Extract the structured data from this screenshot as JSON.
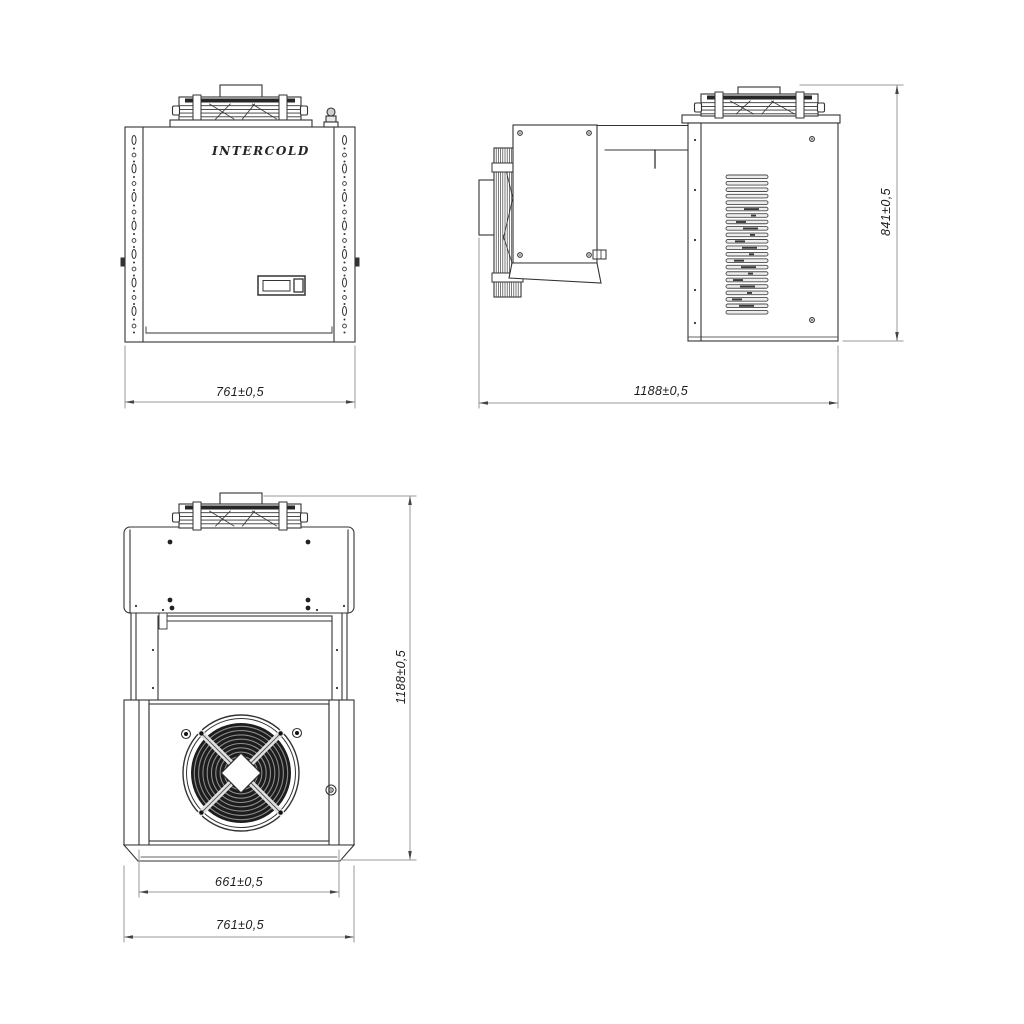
{
  "brand": "INTERCOLD",
  "views": {
    "front": {
      "dim_width": "761±0,5"
    },
    "side": {
      "dim_length": "1188±0,5",
      "dim_height": "841±0,5"
    },
    "plan": {
      "dim_fan_section": "661±0,5",
      "dim_width": "761±0,5",
      "dim_length": "1188±0,5"
    }
  },
  "colors": {
    "background": "#ffffff",
    "line": "#333333",
    "dimension_line": "#9a9a9a",
    "text": "#1c1c1c",
    "dark_fill": "#1d1d1d",
    "louver_fill": "#ededed"
  }
}
